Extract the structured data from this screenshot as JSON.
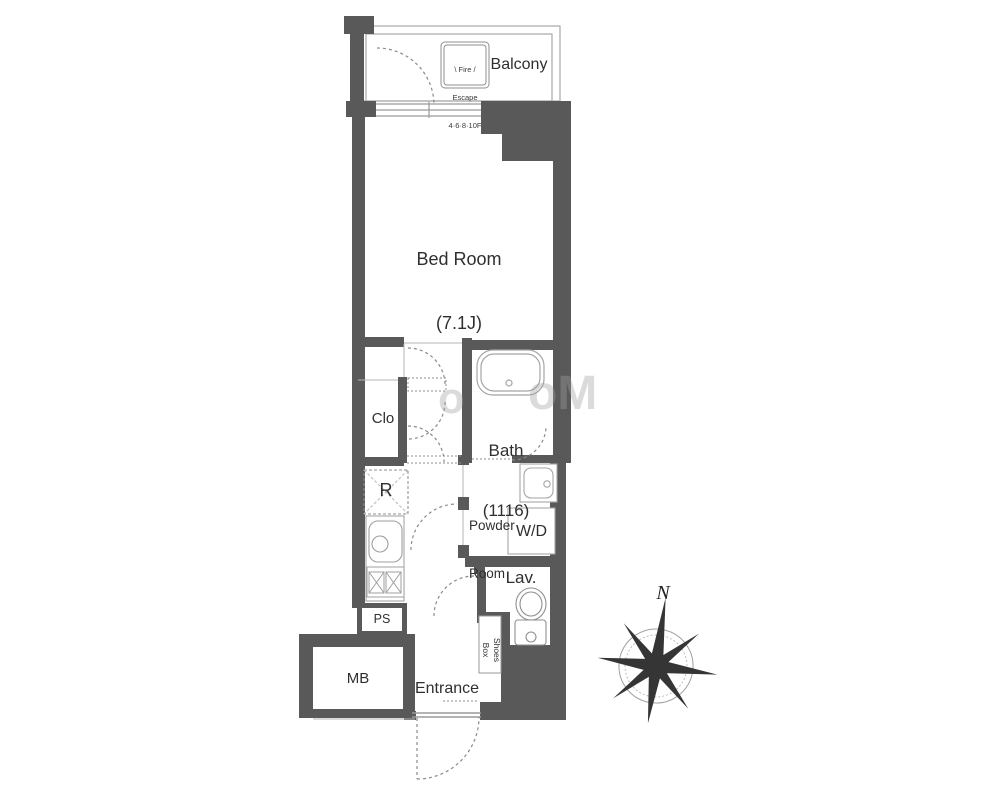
{
  "balcony": {
    "label": "Balcony",
    "fire_escape": {
      "line1": "\\ Fire /",
      "line2": "Escape",
      "line3": "4·6·8·10F"
    }
  },
  "rooms": {
    "bedroom": {
      "name": "Bed Room",
      "size": "(7.1J)"
    },
    "bath": {
      "name": "Bath",
      "size": "(1116)"
    },
    "closet": {
      "label": "Clo"
    },
    "refrigerator": {
      "label": "R"
    },
    "powder_room": {
      "line1": "Powder",
      "line2": "Room"
    },
    "washer_dryer": {
      "label": "W/D"
    },
    "lavatory": {
      "label": "Lav."
    },
    "pipe_shaft": {
      "label": "PS"
    },
    "meter_box": {
      "label": "MB"
    },
    "entrance": {
      "label": "Entrance"
    },
    "shoes_box": {
      "line1": "Shoes",
      "line2": "Box"
    }
  },
  "compass": {
    "label": "N"
  },
  "watermark": {
    "fragment_left": "o",
    "fragment_right": "oM"
  },
  "colors": {
    "wall": "#595959",
    "thin_line": "#9a9a9a",
    "fixture_line": "#aaaaaa",
    "text": "#2f2f2f"
  }
}
